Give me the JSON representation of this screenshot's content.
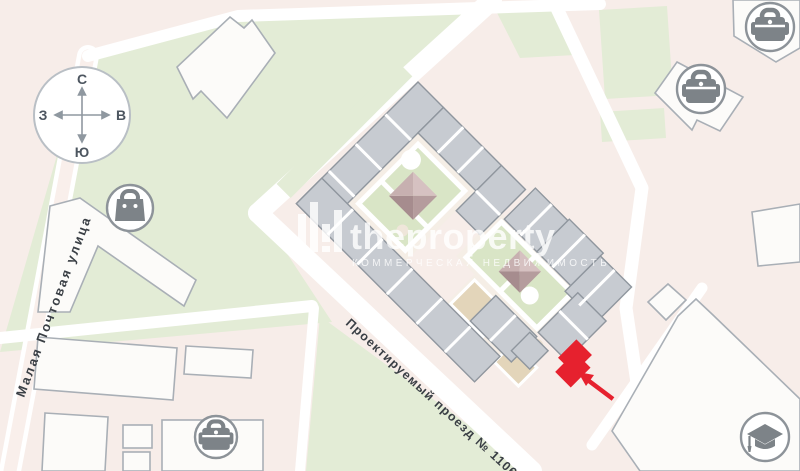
{
  "theme": {
    "bg": "#f7ede9",
    "green": "#e3ecd6",
    "lawn": "#d9e5c6",
    "road": "#ffffff",
    "road_pink": "#f9efeb",
    "building_white": "#fcfbf9",
    "building_stroke": "#a9afb6",
    "gray_fill": "#c7cbd1",
    "gray_stroke": "#8f969e",
    "courtyard": "#f5eee6",
    "sand": "#e3d5ba",
    "roof_light": "#d6c1c1",
    "roof_left": "#c7b0b0",
    "roof_right": "#b59c9d",
    "roof_dark": "#a68c8e",
    "red": "#e6212e",
    "icon_gray": "#7d8388",
    "icon_stroke": "#8d9399",
    "text_dark": "#3a3f45",
    "compass_stroke": "#b9bfc5",
    "watermark": "rgba(255,255,255,0.8)"
  },
  "compass": {
    "north": "С",
    "south": "Ю",
    "west": "З",
    "east": "В"
  },
  "streets": [
    {
      "name": "Малая Почтовая улица"
    },
    {
      "name": "Проектируемый проезд № 1106"
    }
  ],
  "watermark": {
    "brand": "theproperty",
    "tagline": "КОММЕРЧЕСКАЯ НЕДВИЖИМОСТЬ"
  },
  "icons": [
    {
      "name": "bag-icon"
    },
    {
      "name": "briefcase-icon"
    },
    {
      "name": "briefcase-icon"
    },
    {
      "name": "briefcase-icon"
    },
    {
      "name": "graduation-cap-icon"
    }
  ],
  "highlight": {
    "color": "#e6212e"
  }
}
